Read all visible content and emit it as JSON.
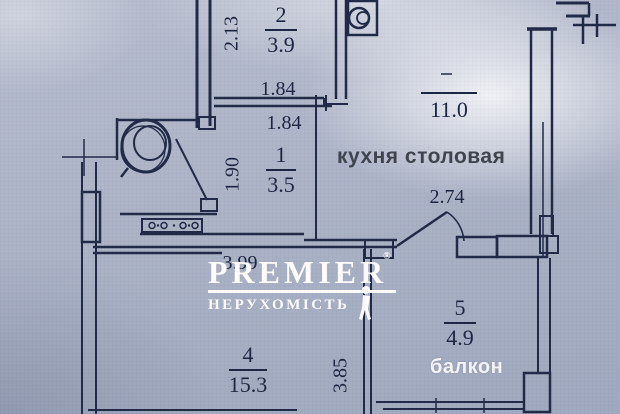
{
  "plan": {
    "rooms": {
      "room1": {
        "number": "1",
        "area": "3.5"
      },
      "room2": {
        "number": "2",
        "area": "3.9"
      },
      "room4": {
        "number": "4",
        "area": "15.3"
      },
      "room5": {
        "number": "5",
        "area": "4.9"
      }
    },
    "kitchen": {
      "area": "11.0",
      "label": "кухня столовая"
    },
    "balcony_label": "балкон",
    "dimensions": {
      "room2_height": "2.13",
      "room2_width": "1.84",
      "room1_width": "1.84",
      "room1_height": "1.90",
      "kitchen_door_width": "2.74",
      "room4_width": "3.99",
      "room4_height": "3.85"
    }
  },
  "watermark": {
    "brand": "PREMIER",
    "registered": "®",
    "subtitle": "НЕРУХОМІСТЬ"
  },
  "colors": {
    "wall": "#212b48",
    "background": "#aeb5c8",
    "label_dark": "#3f444e",
    "label_light": "#f3f4f6",
    "watermark": "#ffffff"
  }
}
